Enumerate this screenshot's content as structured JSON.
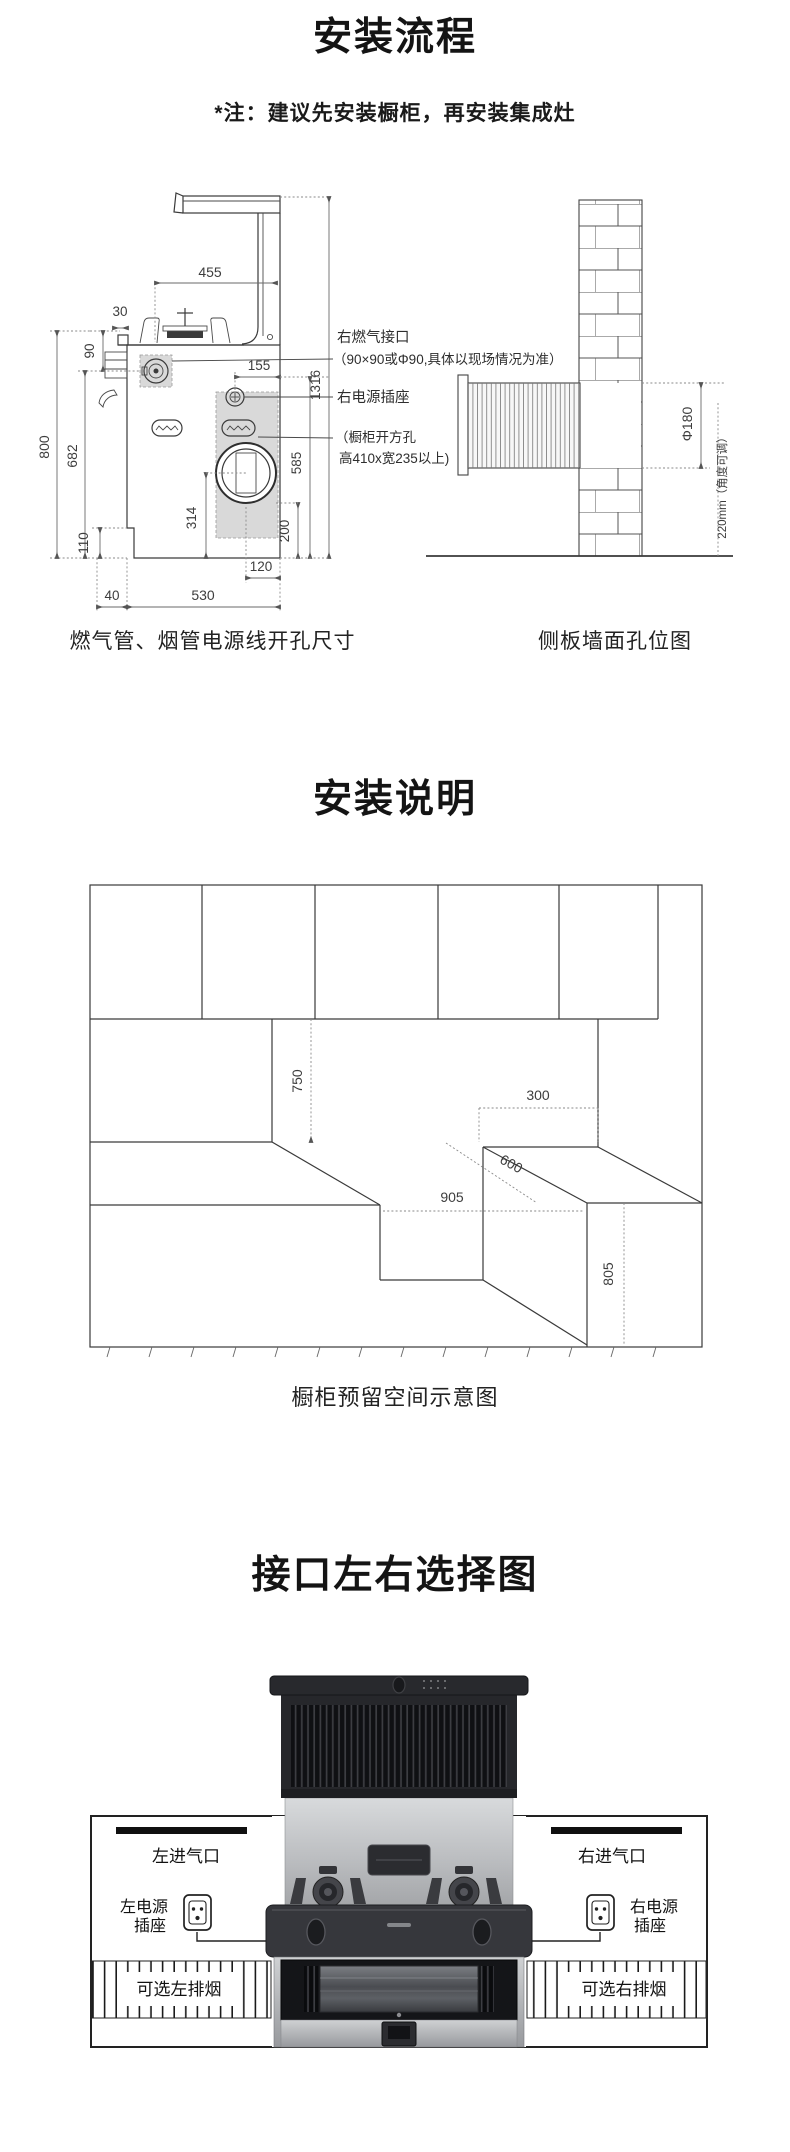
{
  "doc": {
    "s1": {
      "title": "安装流程",
      "note": "*注：建议先安装橱柜，再安装集成灶",
      "fig1": {
        "caption": "燃气管、烟管电源线开孔尺寸",
        "d455": "455",
        "d30": "30",
        "d90": "90",
        "d800": "800",
        "d682": "682",
        "d110": "110",
        "d40": "40",
        "d530": "530",
        "d120": "120",
        "d314": "314",
        "d200": "200",
        "d585": "585",
        "d1316": "1316",
        "d155": "155",
        "callout_gas": "右燃气接口",
        "callout_gas_note": "（90×90或Φ90,具体以现场情况为准）",
        "callout_socket": "右电源插座",
        "callout_cutout_1": "（橱柜开方孔",
        "callout_cutout_2": "高410x宽235以上)"
      },
      "fig2": {
        "caption": "侧板墙面孔位图",
        "dia": "Φ180",
        "h220": "220mm（角度可调）"
      }
    },
    "s2": {
      "title": "安装说明",
      "caption": "橱柜预留空间示意图",
      "d750": "750",
      "d300": "300",
      "d600": "600",
      "d905": "905",
      "d805": "805"
    },
    "s3": {
      "title": "接口左右选择图",
      "left_inlet": "左进气口",
      "left_power_1": "左电源",
      "left_power_2": "插座",
      "left_vent": "可选左排烟",
      "right_inlet": "右进气口",
      "right_power_1": "右电源",
      "right_power_2": "插座",
      "right_vent": "可选右排烟"
    }
  }
}
